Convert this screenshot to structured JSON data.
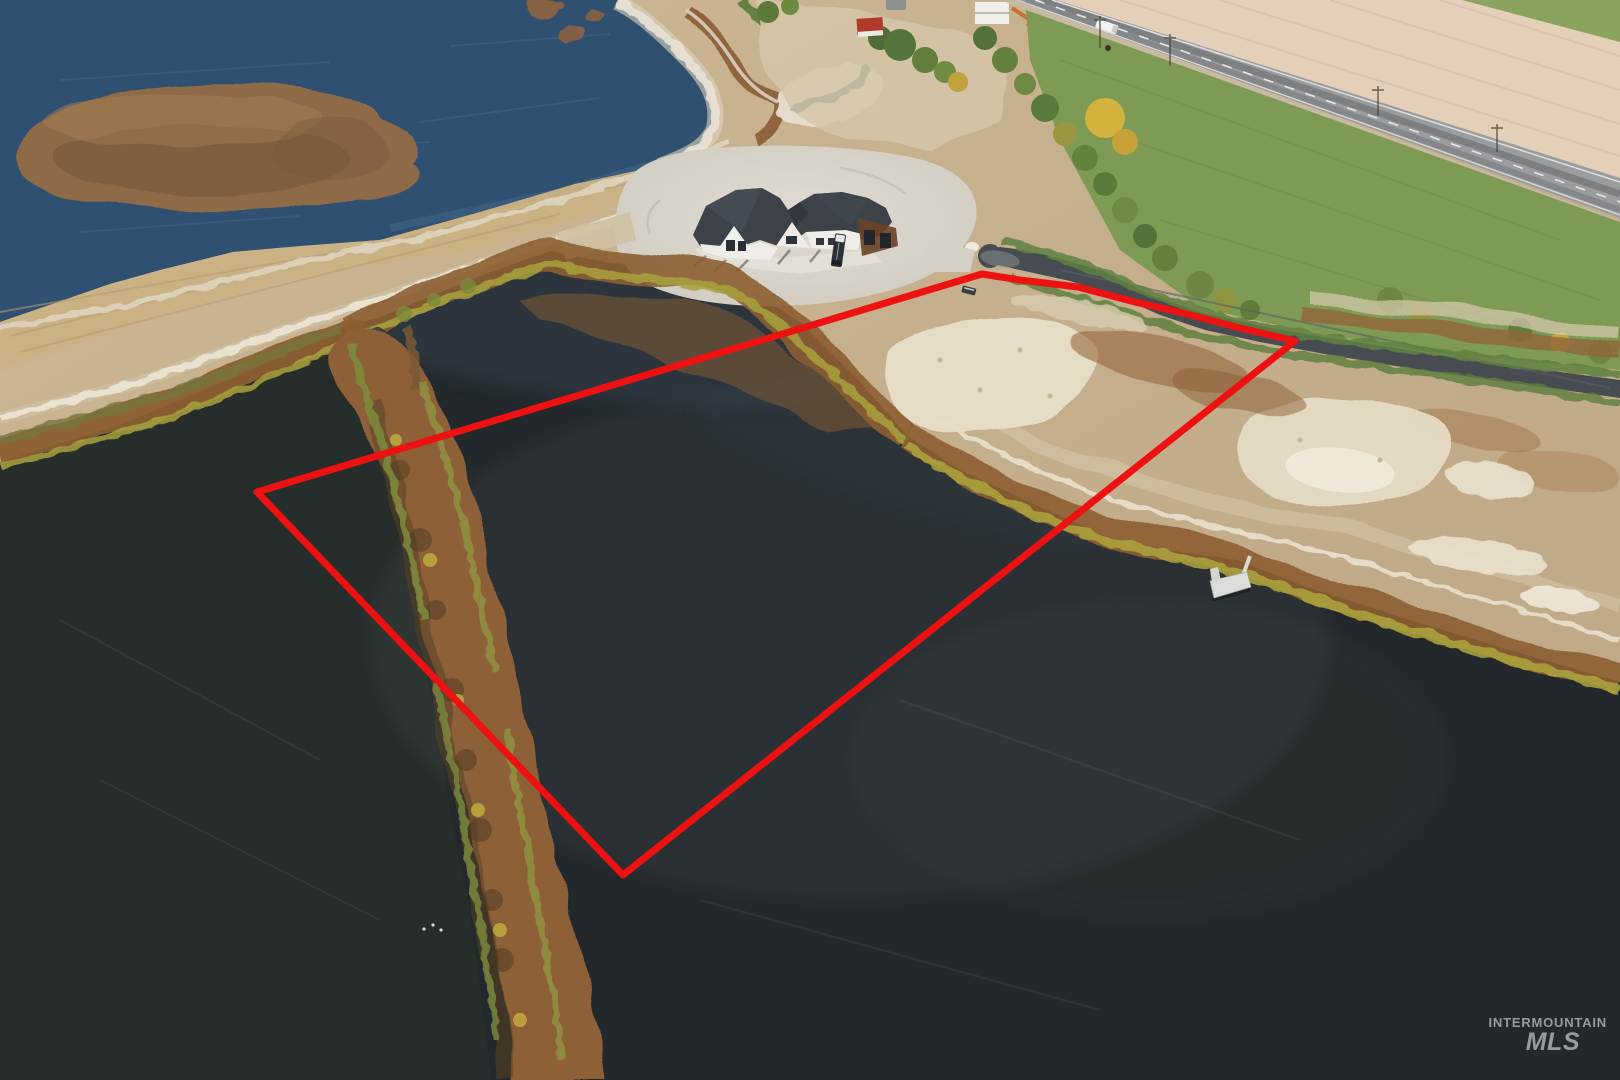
{
  "watermark": {
    "line1": "INTERMOUNTAIN",
    "line2": "MLS",
    "color": "#b7bcbf"
  },
  "property_outline": {
    "color": "#ee1111",
    "stroke_width": 7
  },
  "palette": {
    "lower_lake": "#22282b",
    "upper_lake": "#2f5071",
    "island": "#8e6a47",
    "land": "#c7b190",
    "field_green": "#7e9b56",
    "field_tan": "#e4cfb8",
    "highway": "#9b9c9e",
    "street": "#474c52",
    "house_roof": "#3d4248",
    "house_wall": "#efede8",
    "vegetation_rust": "#8d5e33",
    "shore_grass": "#a9a23d",
    "sand": "#e7dfca",
    "dock": "#dcdcd8"
  }
}
